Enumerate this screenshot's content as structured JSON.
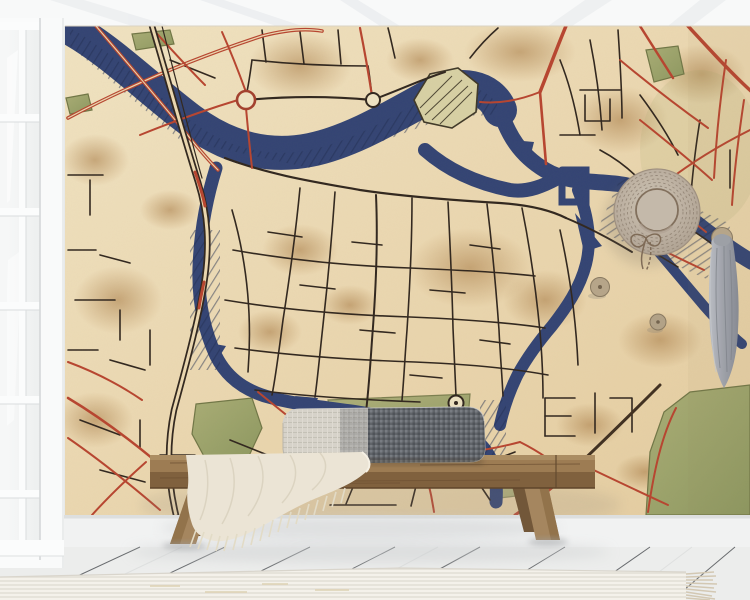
{
  "scene": {
    "kind": "interior-mockup-photo",
    "objects": [
      "ceiling-with-beams",
      "french-window",
      "wall-mural-vintage-city-map",
      "map-river-canal-ring",
      "map-red-roads",
      "map-black-streets",
      "map-parks",
      "map-roundabout-nodes",
      "straw-hat-on-wall",
      "wooden-wall-knobs",
      "hanging-grey-scarf",
      "wooden-bench",
      "two-tone-lumbar-cushion",
      "fringed-throw-blanket",
      "white-plank-floor",
      "ribbed-rug-with-fringe"
    ]
  },
  "colors": {
    "wall": "#f4f5f5",
    "ceiling": "#f8f9f9",
    "mural_parchment": "#ead6ae",
    "mural_parchment_dark": "#c89e66",
    "river": "#2e3f70",
    "river_dark": "#1d2a4e",
    "street": "#2b2118",
    "road_red": "#b5402a",
    "road_dark": "#3a2a1a",
    "park": "#9aa065",
    "park_dark": "#6d7342",
    "island": "#d6cfa2",
    "wood": "#9a784e",
    "wood_dark": "#6e5233",
    "cushion_light": "#d3cfc6",
    "cushion_dark": "#5d6166",
    "blanket": "#ebe4d4",
    "rug": "#efece4",
    "floor": "#ecedec",
    "glass": "#f3f5f6",
    "hat": "#c0b4a5",
    "hat_line": "#8d7f6f",
    "scarf": "#a3a6ad",
    "knob": "#b4a386",
    "baseboard": "#f1f2f2",
    "shadow": "#b9bdbf"
  }
}
